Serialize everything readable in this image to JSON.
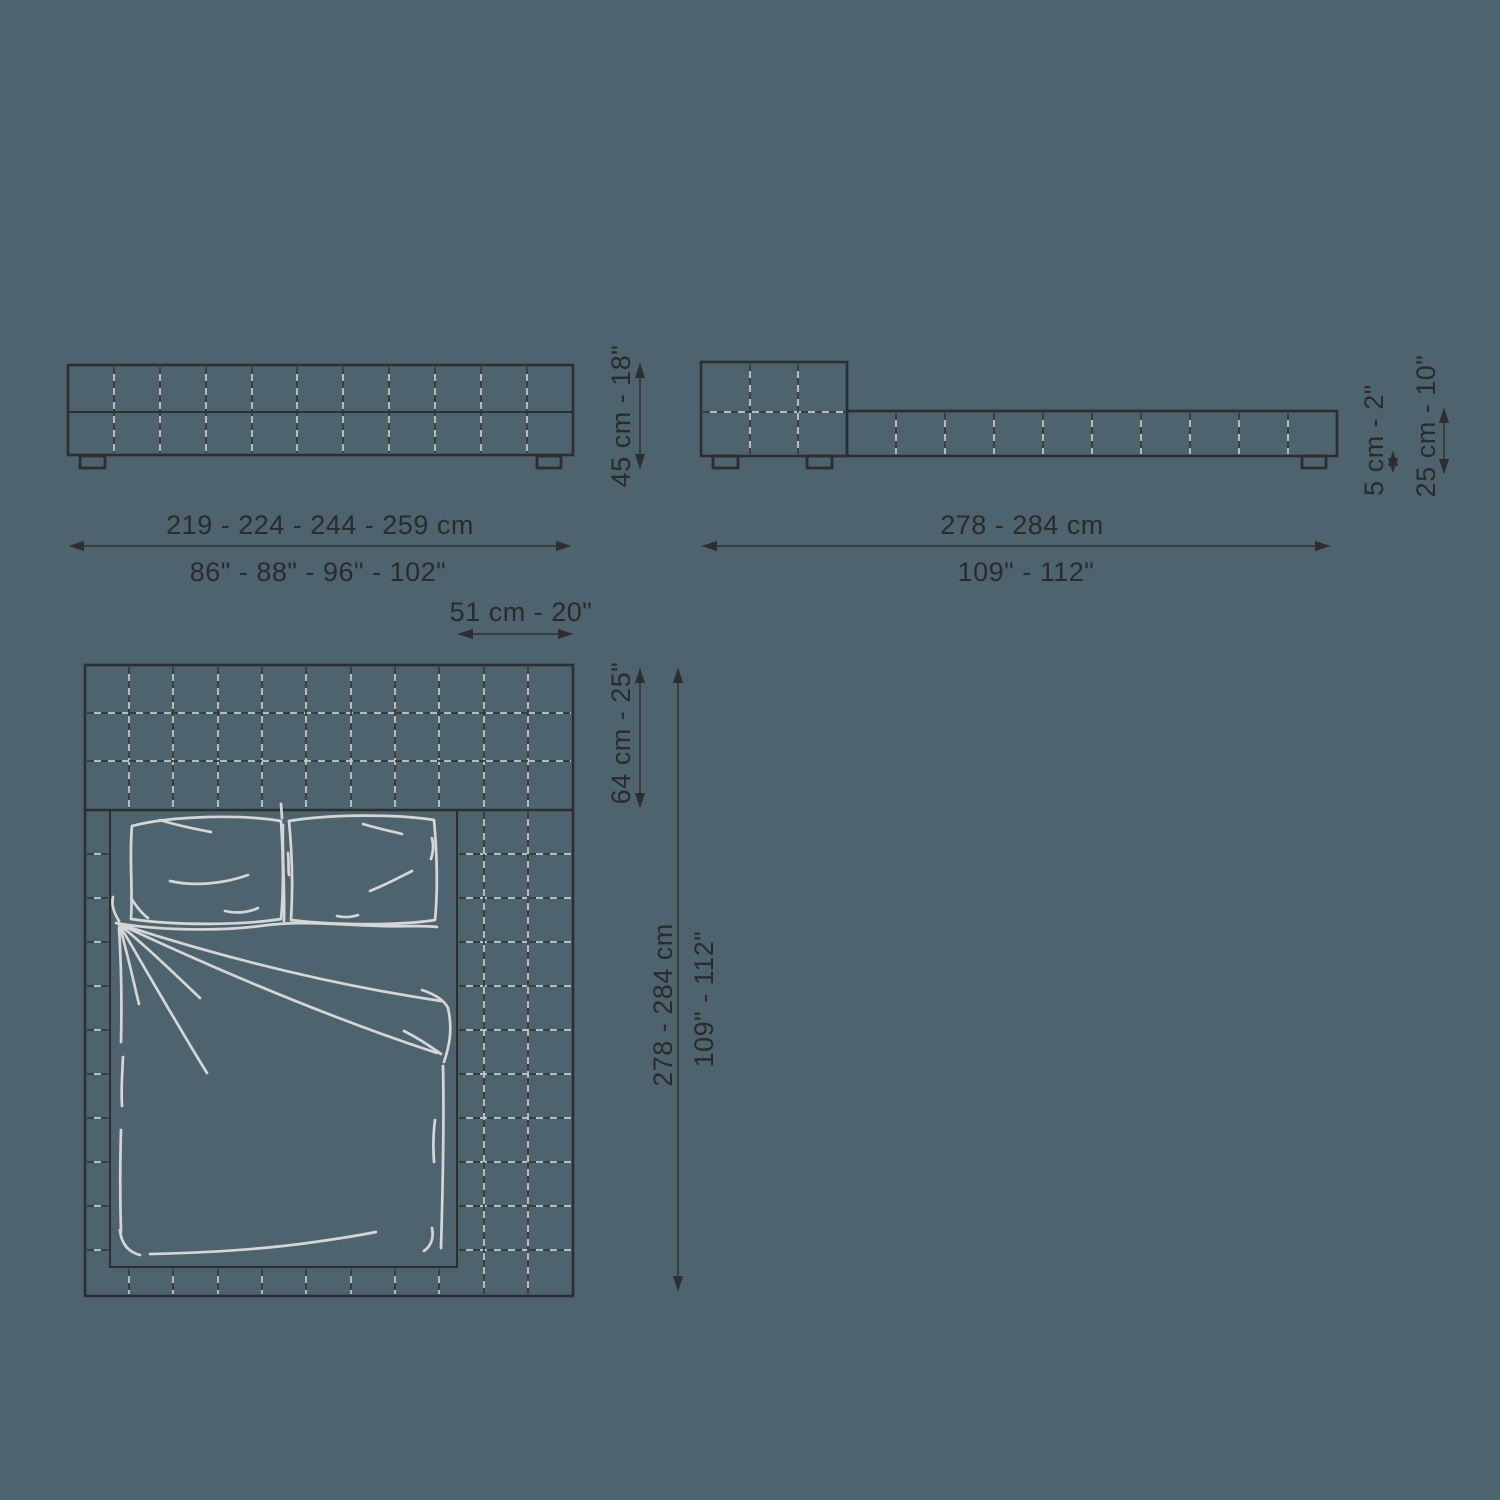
{
  "colors": {
    "background": "#4d636d",
    "line": "#2e2e2e",
    "sketch": "#d6d6d6"
  },
  "front_view": {
    "width_cm": "219 - 224 - 244 - 259 cm",
    "width_in": "86\" - 88\" - 96\" - 102\"",
    "height": "45 cm - 18\""
  },
  "side_view": {
    "length_cm": "278 - 284 cm",
    "length_in": "109\" - 112\"",
    "feet_height": "5 cm - 2\"",
    "frame_height": "25 cm - 10\""
  },
  "plan_view": {
    "side_extension": "51 cm - 20\"",
    "headboard_depth": "64 cm - 25\"",
    "length_cm": "278 - 284 cm",
    "length_in": "109\" - 112\""
  }
}
